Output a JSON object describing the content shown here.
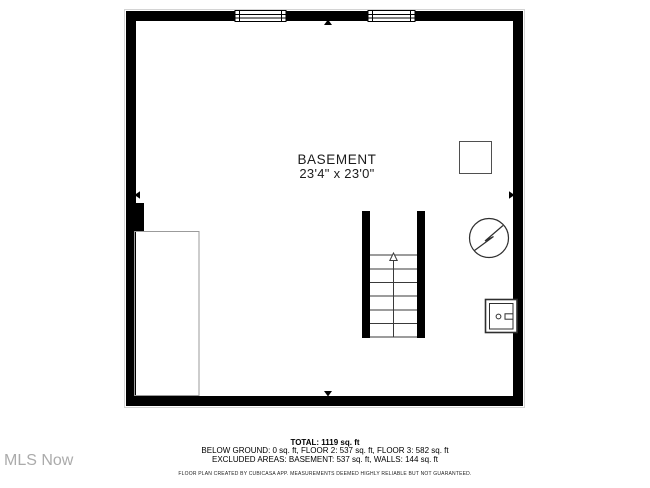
{
  "plan": {
    "room": {
      "name": "BASEMENT",
      "dimensions": "23'4\" x 23'0\""
    },
    "symbols": [
      "window",
      "window",
      "staircase-up-arrow",
      "water-heater-circle-bolt",
      "furnace-appliance",
      "fixture-square",
      "storage-area-outline",
      "measure-arrow-top",
      "measure-arrow-bottom",
      "measure-arrow-left",
      "measure-arrow-right"
    ]
  },
  "summary": {
    "total": "TOTAL: 1119 sq. ft",
    "floors": "BELOW GROUND: 0 sq. ft, FLOOR 2: 537 sq. ft, FLOOR 3: 582 sq. ft",
    "excluded": "EXCLUDED AREAS: BASEMENT: 537 sq. ft, WALLS: 144 sq. ft",
    "disclaimer": "FLOOR PLAN CREATED BY CUBICASA APP. MEASUREMENTS DEEMED HIGHLY RELIABLE BUT NOT GUARANTEED."
  },
  "watermark": "MLS Now",
  "colors": {
    "wall": "#000000",
    "thin_line": "#3a3a3a",
    "gray_outline": "#9b9b9b",
    "watermark": "#ababab",
    "background": "#ffffff"
  }
}
